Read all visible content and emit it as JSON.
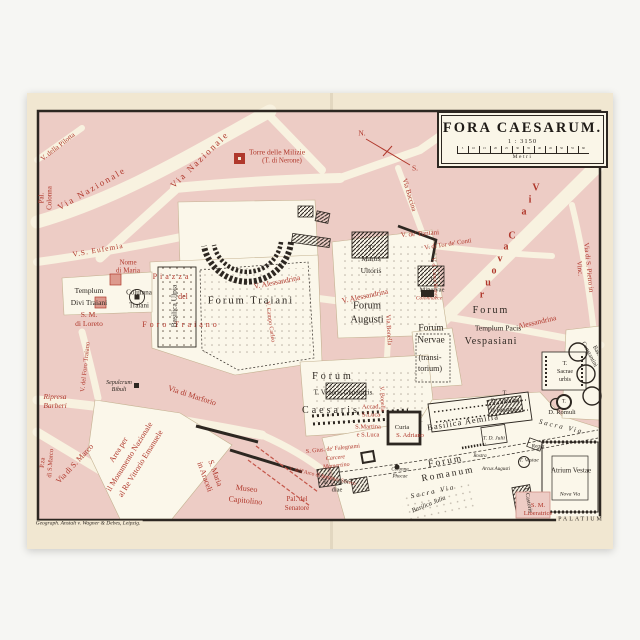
{
  "map": {
    "title_block": {
      "title": "FORA CAESARUM.",
      "scale": "1 : 3150",
      "unit": "Metri",
      "ticks": [
        "5",
        "10",
        "15",
        "20",
        "25",
        "30",
        "35",
        "40",
        "45",
        "50",
        "55",
        "60"
      ]
    },
    "credit": "Geograph. Anstalt v. Wagner & Debes, Leipzig.",
    "colors": {
      "paper": "#f1e7d1",
      "block_pink": "#edccc5",
      "street_cream": "#f8f2e0",
      "excavation_white": "#fbf7ea",
      "red_ink": "#b0382c",
      "black_ink": "#2d2721"
    },
    "compass": {
      "north": "N.",
      "south": "S."
    },
    "labels": [
      {
        "name": "label-v-della-pilotta",
        "text": "V. della Pilotta",
        "x": 58,
        "y": 147,
        "rot": -38,
        "size": 7,
        "color": "red"
      },
      {
        "name": "label-pal-colonna",
        "text": "Pal.\nColonna",
        "x": 46,
        "y": 198,
        "rot": -90,
        "size": 7,
        "color": "red",
        "lh": 1.1
      },
      {
        "name": "label-via-nazionale-west",
        "text": "Via Nazionale",
        "x": 92,
        "y": 189,
        "rot": -30,
        "size": 9,
        "color": "red",
        "sp": 2
      },
      {
        "name": "label-via-nazionale-north",
        "text": "Via Nazionale",
        "x": 200,
        "y": 160,
        "rot": -44,
        "size": 9,
        "color": "red",
        "sp": 2
      },
      {
        "name": "label-v-s-eufemia",
        "text": "V.S. Eufemia",
        "x": 98,
        "y": 250,
        "rot": -10,
        "size": 7.5,
        "color": "red",
        "sp": 1
      },
      {
        "name": "label-nome-di-maria",
        "text": "Nome\ndi Maria",
        "x": 128,
        "y": 267,
        "size": 7,
        "color": "red",
        "lh": 1.2
      },
      {
        "name": "label-piazza",
        "text": "Piazza",
        "x": 172,
        "y": 277,
        "size": 8,
        "color": "red",
        "sp": 3
      },
      {
        "name": "label-del",
        "text": "del",
        "x": 183,
        "y": 297,
        "size": 8,
        "color": "red"
      },
      {
        "name": "label-foro-traiano",
        "text": "Foro Traiano",
        "x": 181,
        "y": 325,
        "size": 8,
        "color": "red",
        "sp": 3
      },
      {
        "name": "label-s-m-di-loreto",
        "text": "S. M.\ndi Loreto",
        "x": 89,
        "y": 319,
        "size": 7.5,
        "color": "red",
        "lh": 1.2
      },
      {
        "name": "label-v-del-foro-traiano",
        "text": "V. del Foro Traiano",
        "x": 86,
        "y": 367,
        "rot": -84,
        "size": 6.5,
        "color": "red"
      },
      {
        "name": "label-ripresa-barberi",
        "text": "Ripresa\nBarberi",
        "x": 55,
        "y": 401,
        "size": 7.5,
        "color": "red",
        "italic": true,
        "lh": 1.2
      },
      {
        "name": "label-sepulcrum-bibuli",
        "text": "Sepulcrum\nBibuli",
        "x": 119,
        "y": 387,
        "size": 6,
        "color": "blk",
        "italic": true,
        "lh": 1.2
      },
      {
        "name": "label-via-di-marforio",
        "text": "Via di Marforio",
        "x": 192,
        "y": 396,
        "rot": 18,
        "size": 8,
        "color": "red"
      },
      {
        "name": "label-area-monumento",
        "text": "Area per\nil Monumento Nazionale\nal Re Vittorio Emanuele",
        "x": 130,
        "y": 457,
        "rot": -58,
        "size": 8,
        "color": "red",
        "lh": 1.6
      },
      {
        "name": "label-pza-di-s-marco",
        "text": "P.za\ndi S.Marco",
        "x": 47,
        "y": 463,
        "rot": -86,
        "size": 6.5,
        "color": "red",
        "lh": 1.2
      },
      {
        "name": "label-via-di-s-marco",
        "text": "Via di S. Marco",
        "x": 75,
        "y": 464,
        "rot": -47,
        "size": 8,
        "color": "red"
      },
      {
        "name": "label-s-maria-in-araceli",
        "text": "S. Maria\nin Araceli",
        "x": 210,
        "y": 475,
        "rot": 70,
        "size": 8,
        "color": "red",
        "lh": 1.4
      },
      {
        "name": "label-museo-capitolino",
        "text": "Museo\nCapitolino",
        "x": 246,
        "y": 495,
        "rot": 6,
        "size": 8,
        "color": "red",
        "lh": 1.5
      },
      {
        "name": "label-pal-del-senatore",
        "text": "Pal. del\nSenatore",
        "x": 297,
        "y": 504,
        "size": 7,
        "color": "red",
        "lh": 1.3
      },
      {
        "name": "label-s-gius-falegnami",
        "text": "S. Gius. de' Falegnami",
        "x": 333,
        "y": 450,
        "rot": -6,
        "size": 6,
        "color": "red"
      },
      {
        "name": "label-carcere-mamertino",
        "text": "Carcere\nMamertino",
        "x": 336,
        "y": 463,
        "rot": -6,
        "size": 6,
        "color": "red",
        "italic": true,
        "lh": 1.3
      },
      {
        "name": "label-v-arco-settimio-severo",
        "text": "V. dell'Arco di Settimio Severo",
        "x": 322,
        "y": 477,
        "rot": 13,
        "size": 5.5,
        "color": "red"
      },
      {
        "name": "label-accad-s-luca",
        "text": "Accad.\nS.Luca",
        "x": 371,
        "y": 412,
        "size": 6.5,
        "color": "red",
        "lh": 1.3
      },
      {
        "name": "label-s-martina-s-luca",
        "text": "S.Martina\ne S.Luca",
        "x": 368,
        "y": 432,
        "size": 6.5,
        "color": "red",
        "lh": 1.3
      },
      {
        "name": "label-s-adriano",
        "text": "S. Adriano",
        "x": 410,
        "y": 436,
        "size": 6.5,
        "color": "red"
      },
      {
        "name": "label-via-bonella",
        "text": "Via Bonella",
        "x": 388,
        "y": 330,
        "rot": 87,
        "size": 6.5,
        "color": "red"
      },
      {
        "name": "label-v-bonella-south",
        "text": "V. Bonella",
        "x": 381,
        "y": 399,
        "rot": 87,
        "size": 6,
        "color": "red"
      },
      {
        "name": "label-v-alessandrina-1",
        "text": "V. Alessandrina",
        "x": 277,
        "y": 282,
        "rot": -11,
        "size": 7.5,
        "color": "red"
      },
      {
        "name": "label-v-alessandrina-2",
        "text": "V. Alessandrina",
        "x": 365,
        "y": 296,
        "rot": -12,
        "size": 7.5,
        "color": "red"
      },
      {
        "name": "label-alessandrina-3",
        "text": "Alessandrina",
        "x": 537,
        "y": 322,
        "rot": -13,
        "size": 7.5,
        "color": "red"
      },
      {
        "name": "label-via-cavour",
        "text": "Via Cavour",
        "x": 536,
        "y": 188,
        "x2": 482,
        "y2": 295,
        "size": 10,
        "color": "red"
      },
      {
        "name": "label-v-de-pantani",
        "text": "V. de' Pantani",
        "x": 420,
        "y": 234,
        "rot": -4,
        "size": 7,
        "color": "red"
      },
      {
        "name": "label-v-di-tor-de-conti",
        "text": "V. di Tor de' Conti",
        "x": 448,
        "y": 245,
        "rot": -9,
        "size": 6.5,
        "color": "red"
      },
      {
        "name": "label-via-baccina",
        "text": "Via Baccina",
        "x": 409,
        "y": 195,
        "rot": 73,
        "size": 7,
        "color": "red"
      },
      {
        "name": "label-via-s-pietro-in-vincoli",
        "text": "Via di S. Pietro in Vinc.",
        "x": 584,
        "y": 268,
        "rot": 84,
        "size": 7,
        "color": "red"
      },
      {
        "name": "label-v-croce-bianca",
        "text": "V. d. Croce Bianca",
        "x": 434,
        "y": 278,
        "rot": 86,
        "size": 5.5,
        "color": "red"
      },
      {
        "name": "label-colonnacce",
        "text": "Colonnacce",
        "x": 429,
        "y": 299,
        "size": 5.5,
        "color": "red",
        "italic": true
      },
      {
        "name": "label-torre-delle-milizie",
        "text": "Torre delle Milizie",
        "x": 277,
        "y": 152,
        "size": 7.5,
        "color": "red"
      },
      {
        "name": "label-t-di-nerone",
        "text": "(T. di Nerone)",
        "x": 282,
        "y": 161,
        "size": 7,
        "color": "red"
      },
      {
        "name": "label-v-campo-carleo",
        "text": "V. Campo Carleo",
        "x": 269,
        "y": 322,
        "rot": 82,
        "size": 6,
        "color": "red"
      },
      {
        "name": "label-s-m-liberatrice",
        "text": "S. M.\nLiberatrice",
        "x": 538,
        "y": 510,
        "size": 6.5,
        "color": "red",
        "lh": 1.2
      },
      {
        "name": "label-compass-n",
        "text": "N.",
        "x": 362,
        "y": 133,
        "size": 7.5,
        "color": "red"
      },
      {
        "name": "label-compass-s",
        "text": "S.",
        "x": 415,
        "y": 168,
        "size": 7.5,
        "color": "red"
      },
      {
        "name": "label-templum-divi-traiani",
        "text": "Templum\nDivi Traiani",
        "x": 89,
        "y": 297,
        "size": 7.5,
        "color": "blk",
        "lh": 1.6
      },
      {
        "name": "label-columna-traiani",
        "text": "Columna\nTraiani",
        "x": 139,
        "y": 299,
        "size": 7,
        "color": "blk",
        "lh": 1.8
      },
      {
        "name": "label-basilica-ulpia",
        "text": "Basilica Ulpia",
        "x": 174,
        "y": 306,
        "rot": -90,
        "size": 7.5,
        "color": "blk"
      },
      {
        "name": "label-forum-traiani",
        "text": "Forum Traiani",
        "x": 251,
        "y": 301,
        "size": 10.5,
        "color": "blk",
        "sp": 2
      },
      {
        "name": "label-t-martis-ultoris",
        "text": "T.\nMartis\nUltoris",
        "x": 371,
        "y": 259,
        "size": 7.5,
        "color": "blk",
        "lh": 1.5
      },
      {
        "name": "label-forum-augusti",
        "text": "Forum\nAugusti",
        "x": 367,
        "y": 313,
        "size": 10.5,
        "color": "blk",
        "lh": 1.3
      },
      {
        "name": "label-forum-nervae",
        "text": "Forum\nNervae",
        "x": 431,
        "y": 335,
        "size": 9.5,
        "color": "blk",
        "lh": 1.3
      },
      {
        "name": "label-transitorium",
        "text": "(transi-\ntorium)",
        "x": 430,
        "y": 363,
        "size": 8,
        "color": "blk",
        "lh": 1.4
      },
      {
        "name": "label-forum-vespasiani-1",
        "text": "Forum",
        "x": 491,
        "y": 311,
        "size": 10,
        "color": "blk",
        "sp": 2
      },
      {
        "name": "label-templum-pacis",
        "text": "Templum Pacis",
        "x": 498,
        "y": 328,
        "size": 7.5,
        "color": "blk"
      },
      {
        "name": "label-forum-vespasiani-2",
        "text": "Vespasiani",
        "x": 491,
        "y": 342,
        "size": 10,
        "color": "blk",
        "sp": 1
      },
      {
        "name": "label-t-minervae",
        "text": "T.\nMinervae",
        "x": 432,
        "y": 285,
        "size": 6.5,
        "color": "blk",
        "lh": 1.5
      },
      {
        "name": "label-forum-caesaris-1",
        "text": "Forum",
        "x": 333,
        "y": 377,
        "size": 10,
        "color": "blk",
        "sp": 3
      },
      {
        "name": "label-t-veneris-genetricis",
        "text": "T. Veneris Genetricis",
        "x": 343,
        "y": 393,
        "size": 7,
        "color": "blk"
      },
      {
        "name": "label-forum-caesaris-2",
        "text": "Caesaris",
        "x": 331,
        "y": 411,
        "size": 10,
        "color": "blk",
        "sp": 3
      },
      {
        "name": "label-curia",
        "text": "Curia",
        "x": 402,
        "y": 428,
        "size": 6.5,
        "color": "blk"
      },
      {
        "name": "label-basilica-aemilia",
        "text": "Basilica Aemilia",
        "x": 463,
        "y": 422,
        "rot": -9,
        "size": 8.5,
        "color": "blk",
        "sp": 1
      },
      {
        "name": "label-t-d-antonini",
        "text": "T.\nD. Antonini\net Faustinae",
        "x": 505,
        "y": 402,
        "size": 6,
        "color": "blk",
        "lh": 1.4
      },
      {
        "name": "label-d-romuli",
        "text": "D. Romuli",
        "x": 562,
        "y": 413,
        "size": 6.5,
        "color": "blk"
      },
      {
        "name": "label-t-sacrae-urbis",
        "text": "T.\nSacrae\nurbis",
        "x": 565,
        "y": 372,
        "size": 6,
        "color": "blk",
        "lh": 1.35
      },
      {
        "name": "label-t-circle",
        "text": "T.",
        "x": 564,
        "y": 402,
        "size": 5.5,
        "color": "blk"
      },
      {
        "name": "label-bas-constantini",
        "text": "Bas.\nConstantini",
        "x": 592,
        "y": 353,
        "rot": 62,
        "size": 6,
        "color": "blk",
        "lh": 1.3
      },
      {
        "name": "label-sacra-via-east",
        "text": "Sacra Via",
        "x": 561,
        "y": 427,
        "rot": 13,
        "size": 7,
        "color": "blk",
        "italic": true,
        "sp": 2
      },
      {
        "name": "label-sacra-via-west",
        "text": "Sacra Via",
        "x": 433,
        "y": 492,
        "rot": -12,
        "size": 7,
        "color": "blk",
        "italic": true,
        "sp": 2
      },
      {
        "name": "label-t-d-julii",
        "text": "T. D. Julii",
        "x": 494,
        "y": 439,
        "size": 5.5,
        "color": "blk",
        "italic": true
      },
      {
        "name": "label-regia",
        "text": "Regia",
        "x": 538,
        "y": 447,
        "size": 5.5,
        "color": "blk",
        "italic": true
      },
      {
        "name": "label-t-vestae",
        "text": "T. Vestae",
        "x": 529,
        "y": 461,
        "size": 5.5,
        "color": "blk",
        "italic": true
      },
      {
        "name": "label-atrium-vestae",
        "text": "Atrium Vestae",
        "x": 571,
        "y": 471,
        "size": 7,
        "color": "blk"
      },
      {
        "name": "label-forum-romanum",
        "text": "Forum\nRomanum",
        "x": 447,
        "y": 469,
        "rot": -10,
        "size": 9.5,
        "color": "blk",
        "sp": 2,
        "lh": 1.4
      },
      {
        "name": "label-rostra",
        "text": "Rostra",
        "x": 480,
        "y": 457,
        "size": 5,
        "color": "blk",
        "italic": true
      },
      {
        "name": "label-arcus-augusti",
        "text": "Arcus Augusti",
        "x": 496,
        "y": 470,
        "size": 5,
        "color": "blk",
        "italic": true
      },
      {
        "name": "label-t-castoris",
        "text": "T. Castoris",
        "x": 527,
        "y": 500,
        "rot": 80,
        "size": 6,
        "color": "blk"
      },
      {
        "name": "label-nova-via",
        "text": "Nova Via",
        "x": 570,
        "y": 495,
        "size": 5.5,
        "color": "blk",
        "italic": true
      },
      {
        "name": "label-basilica-julia",
        "text": "Basilica Julia",
        "x": 429,
        "y": 505,
        "rot": -22,
        "size": 6.5,
        "color": "blk",
        "italic": true
      },
      {
        "name": "label-t-concordiae",
        "text": "T. Concor-\ndiae",
        "x": 337,
        "y": 487,
        "size": 6.5,
        "color": "blk",
        "lh": 1.3
      },
      {
        "name": "label-colonna-phocae",
        "text": "Colonna\nPhocae",
        "x": 400,
        "y": 474,
        "size": 5,
        "color": "blk",
        "italic": true,
        "lh": 1.3
      },
      {
        "name": "label-palatium",
        "text": "PALATIUM",
        "x": 581,
        "y": 520,
        "size": 6,
        "color": "blk",
        "sp": 2,
        "bg": true
      },
      {
        "name": "label-credit",
        "text": "Geograph. Anstalt v. Wagner & Debes, Leipzig.",
        "x": 88,
        "y": 524,
        "size": 5.5,
        "color": "blk",
        "italic": true,
        "bg": true
      }
    ]
  }
}
